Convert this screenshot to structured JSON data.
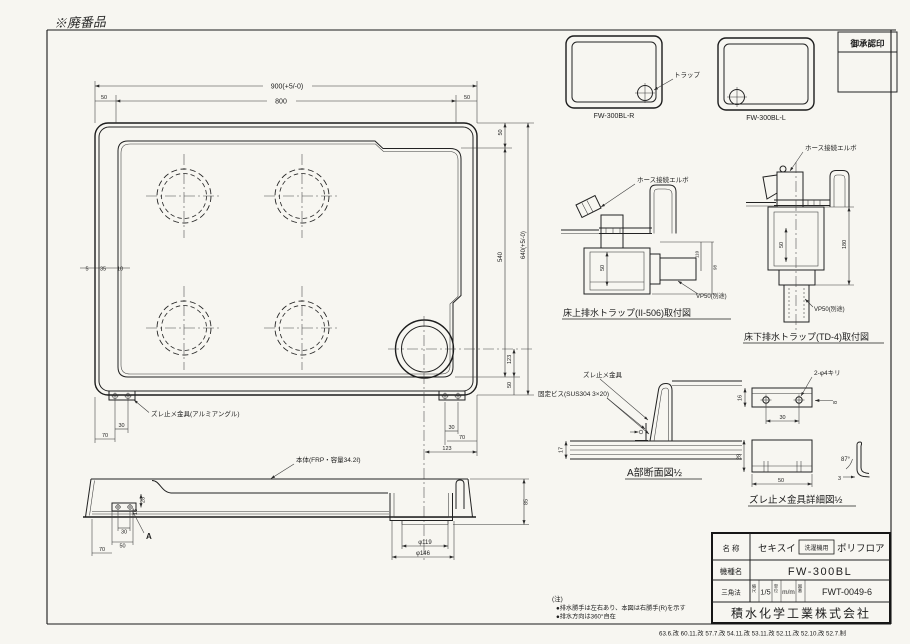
{
  "frame": {
    "handwritten": "※廃番品",
    "approval": "御承認印"
  },
  "thumbs": {
    "r": "FW-300BL-R",
    "l": "FW-300BL-L",
    "trap": "トラップ"
  },
  "plan": {
    "dim_900": "900(+5/-0)",
    "dim_800": "800",
    "dim_50a": "50",
    "dim_50b": "50",
    "dim_50c": "50",
    "dim_540": "540",
    "dim_640": "640(+5/-0)",
    "dim_123v": "123",
    "dim_50d": "50",
    "dim_5": "5",
    "dim_35": "35",
    "dim_10": "10",
    "dim_30l": "30",
    "dim_70l": "70",
    "dim_30r": "30",
    "dim_70r": "70",
    "dim_123h": "123",
    "bracket_label": "ズレ止メ金具(アルミアングル)"
  },
  "side": {
    "body_label": "本体(FRP・容量34.2ℓ)",
    "marker_a": "A",
    "dim_30": "30",
    "dim_50": "50",
    "dim_70": "70",
    "dim_28": "28",
    "dim_16": "16",
    "dim_85": "85",
    "dim_d119": "φ119",
    "dim_d146": "φ146"
  },
  "trap_floor": {
    "caption": "床上排水トラップ(II-506)取付図",
    "elbow": "ホース接続エルボ",
    "pipe": "VP50(別途)",
    "dim_50": "50",
    "dim_110": "110",
    "dim_98": "98"
  },
  "trap_under": {
    "caption": "床下排水トラップ(TD-4)取付図",
    "elbow": "ホース接続エルボ",
    "pipe": "VP50(別途)",
    "dim_50": "50",
    "dim_180": "180"
  },
  "section_a": {
    "caption": "A部断面図½",
    "bracket": "ズレ止メ金具",
    "screw": "固定ビス(SUS304 3×20)",
    "dim_17": "17"
  },
  "bracket_detail": {
    "caption": "ズレ止メ金具詳細図½",
    "holes": "2-φ4キリ",
    "dim_16": "16",
    "dim_30": "30",
    "dim_8": "8",
    "dim_28": "28",
    "dim_50": "50",
    "angle": "87°",
    "dim_3": "3"
  },
  "title_block": {
    "name_label": "名 称",
    "brand": "セキスイ",
    "badge": "洗濯機用",
    "product": "ポリフロア",
    "model_label": "機種名",
    "model": "FW-300BL",
    "method": "三角法",
    "scale_label": "縮尺",
    "scale": "1/5",
    "unit_label": "単位",
    "unit": "m/m",
    "no_label": "図番",
    "number": "FWT-0049-6",
    "company": "積水化学工業株式会社"
  },
  "notes": {
    "head": "(注)",
    "line1": "●排水勝手は左右あり、本図は右勝手(R)を示す",
    "line2": "●排水方向は360°自在"
  },
  "revisions": "63.6.改 60.11.改 57.7.改 54.11.改 53.11.改 52.11.改 52.10.改 52.7.制"
}
